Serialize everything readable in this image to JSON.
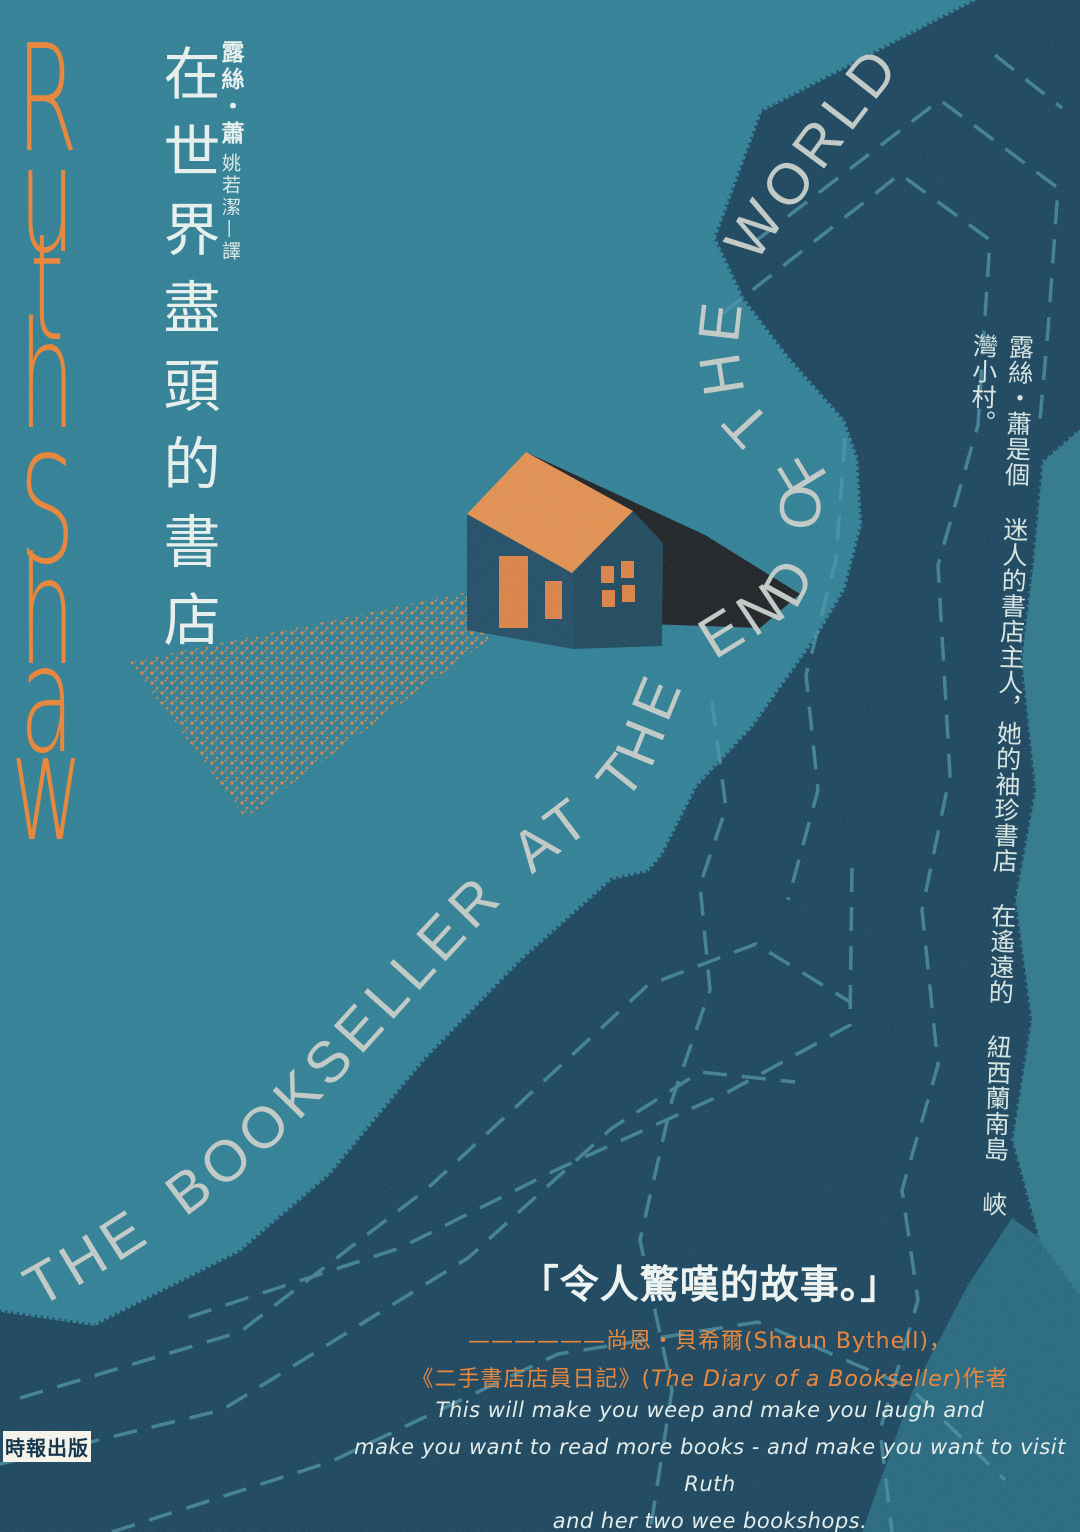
{
  "cover": {
    "author_en": "Ruth Shaw",
    "title_zh": "在世界盡頭的書店",
    "author_zh": "露絲・蕭",
    "translator_zh": "姚若潔—譯",
    "title_en_curved": "THE BOOKSELLER AT THE END OF THE WORLD",
    "side_note_zh": "露絲・蕭是個 迷人的書店主人，她的袖珍書店 在遙遠的 紐西蘭南島 峽灣小村。",
    "quote": {
      "text": "「令人驚嘆的故事。」",
      "attribution_line1": "——————尚恩・貝希爾(Shaun Bythell)，",
      "attribution_line2_pre": "《二手書店店員日記》(",
      "attribution_line2_italic": "The Diary of a Bookseller",
      "attribution_line2_post": ")作者"
    },
    "blurb": {
      "lines": [
        "This will make you weep and make you laugh and",
        "make you want to read more books - and make you want to visit Ruth",
        "and her two wee bookshops."
      ]
    },
    "publisher": "時報出版",
    "colors": {
      "teal": "#2b7e94",
      "teal-strip": "#2a7689",
      "teal-soft": "#21657c",
      "navy": "#143f58",
      "orange": "#e8883f",
      "ivory": "#e7efec",
      "title-grey": "#c9cfc9",
      "dash": "#4a93a6",
      "roof": "#ec9049",
      "shadow-black": "#17191b"
    }
  }
}
